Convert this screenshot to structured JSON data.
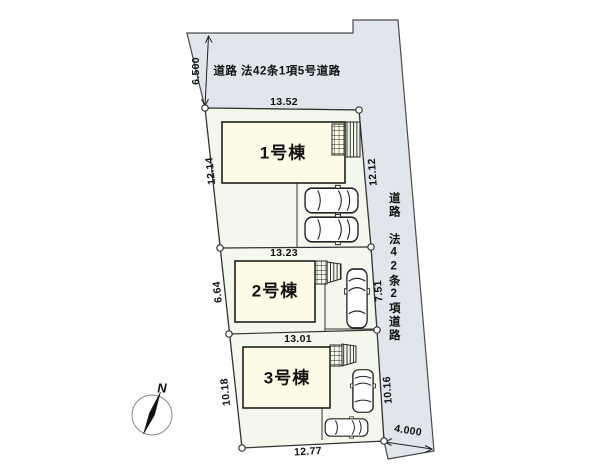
{
  "site_plan": {
    "compass": "N",
    "roads": {
      "top": {
        "label": "道路 法42条1項5号道路",
        "width": "6.500"
      },
      "right": {
        "label": "道路 法42条2項道路",
        "width": "4.000"
      }
    },
    "plots": [
      {
        "label": "1号棟",
        "dim_top": "13.52",
        "dim_left": "12.14",
        "dim_right": "12.12"
      },
      {
        "label": "2号棟",
        "dim_top": "13.23",
        "dim_left": "6.64",
        "dim_right": "7.51"
      },
      {
        "label": "3号棟",
        "dim_top": "13.01",
        "dim_left": "10.18",
        "dim_right": "10.16",
        "dim_bottom": "12.77"
      }
    ],
    "colors": {
      "road_fill": "#e1e5ec",
      "plot_fill": "#f4f7eb",
      "building_fill": "#fefce6",
      "line": "#333333"
    }
  }
}
